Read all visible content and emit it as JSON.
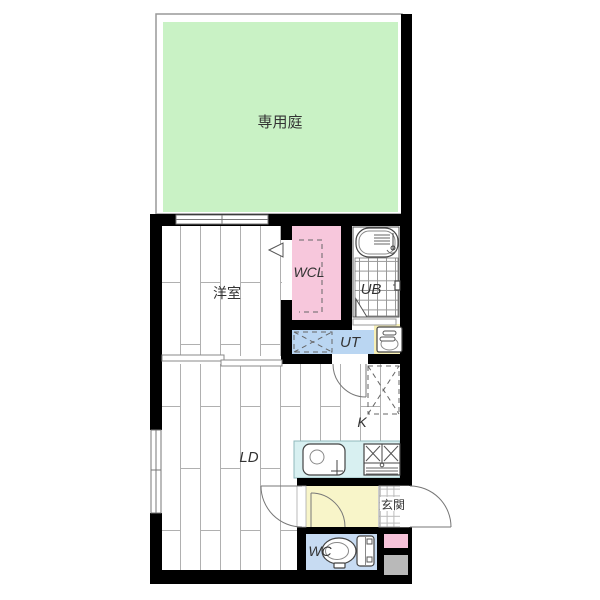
{
  "plan": {
    "rooms": {
      "garden": {
        "label": "専用庭"
      },
      "bedroom": {
        "label": "洋室"
      },
      "wcl": {
        "label": "WCL"
      },
      "bath": {
        "label": "UB"
      },
      "utility": {
        "label": "UT"
      },
      "kitchen": {
        "label": "K"
      },
      "living": {
        "label": "LD"
      },
      "entrance": {
        "label": "玄関"
      },
      "toilet": {
        "label": "WC"
      }
    },
    "colors": {
      "garden": "#c9f2c5",
      "wcl": "#f7c7dc",
      "utility": "#bad6f2",
      "basin": "#f7f0b6",
      "counter": "#d8f0f1",
      "hall": "#f8f5c9",
      "toilet": "#c7dbf2",
      "meter_pink": "#f6c2d9",
      "meter_gray": "#b9b9b9"
    },
    "fixtures": [
      "bathtub-icon",
      "washbasin-icon",
      "kitchen-sink-icon",
      "gas-stove-icon",
      "toilet-icon",
      "washing-machine-space",
      "refrigerator-space"
    ]
  }
}
